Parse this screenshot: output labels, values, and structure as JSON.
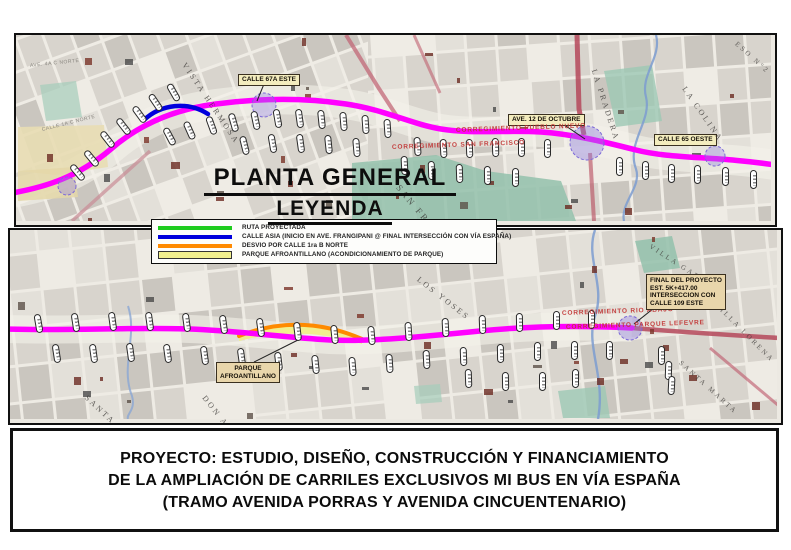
{
  "header": {
    "map_title": "PLANTA GENERAL",
    "legend_title": "LEYENDA"
  },
  "legend": {
    "items": [
      {
        "label": "RUTA PROYECTADA",
        "color": "#1ecc1e"
      },
      {
        "label": "CALLE ASIA (INICIO EN AVE. FRANGIPANI @ FINAL INTERSECCIÓN CON VÍA ESPAÑA)",
        "color": "#0000dd"
      },
      {
        "label": "DESVIO POR CALLE 1ra B NORTE",
        "color": "#ff8a00"
      },
      {
        "label": "PARQUE AFROANTILLANO (ACONDICIONAMIENTO DE PARQUE)",
        "color": "#f1ef8e"
      }
    ]
  },
  "top_map": {
    "street_boxes": {
      "calle_67a_este": "CALLE 67A ESTE",
      "ave_12_de_octubre": "AVE. 12 DE OCTUBRE",
      "calle_65_oeste": "CALLE 65 OESTE"
    },
    "boundary_labels": {
      "pueblo_nuevo": "CORREGIMIENTO PUEBLO NUEVO",
      "san_francisco": "CORREGIMIENTO SAN FRANCISCO"
    },
    "area_labels": {
      "vista_hermosa": "VISTA HERMOSA",
      "san_francisco": "SAN FRANCISCO",
      "la_pradera": "LA PRADERA",
      "la_colina": "LA COLINA",
      "eso_n2": "ESO N°2",
      "ave_4a_c_norte": "AVE. 4A C NORTE",
      "calle_1a_c_norte": "CALLE 1A C NORTE"
    }
  },
  "bottom_map": {
    "boundary_labels": {
      "rio_abajo": "CORREGIMIENTO RIO ABAJO",
      "parque_lefevre": "CORREGIMIENTO PARQUE LEFEVRE"
    },
    "area_labels": {
      "los_yoses": "LOS YOSES",
      "santa_elena": "SANTA ELENA",
      "don_ahorro": "DON AHORRO",
      "villa_gabriela": "VILLA GABRIELA",
      "villa_lorena": "VILLA LORENA",
      "santa_marta": "SANTA MARTA"
    },
    "parque_box": {
      "line1": "PARQUE",
      "line2": "AFROANTILLANO"
    },
    "final_box": {
      "line1": "FINAL DEL PROYECTO",
      "line2": "EST. 5K+417.00",
      "line3": "INTERSECCION CON",
      "line4": "CALLE 109 ESTE"
    }
  },
  "title_block": {
    "line1": "PROYECTO: ESTUDIO, DISEÑO, CONSTRUCCIÓN Y FINANCIAMIENTO",
    "line2": "DE LA AMPLIACIÓN DE CARRILES EXCLUSIVOS MI BUS EN VÍA ESPAÑA",
    "line3": "(TRAMO AVENIDA PORRAS Y AVENIDA CINCUENTENARIO)"
  },
  "colors": {
    "route_magenta": "#ff00ff",
    "calle_asia_blue": "#0000dd",
    "desvio_orange": "#ff8a00",
    "parque_yellow": "#f1ef8e",
    "ruta_green": "#1ecc1e",
    "boundary_red": "#c23434"
  }
}
